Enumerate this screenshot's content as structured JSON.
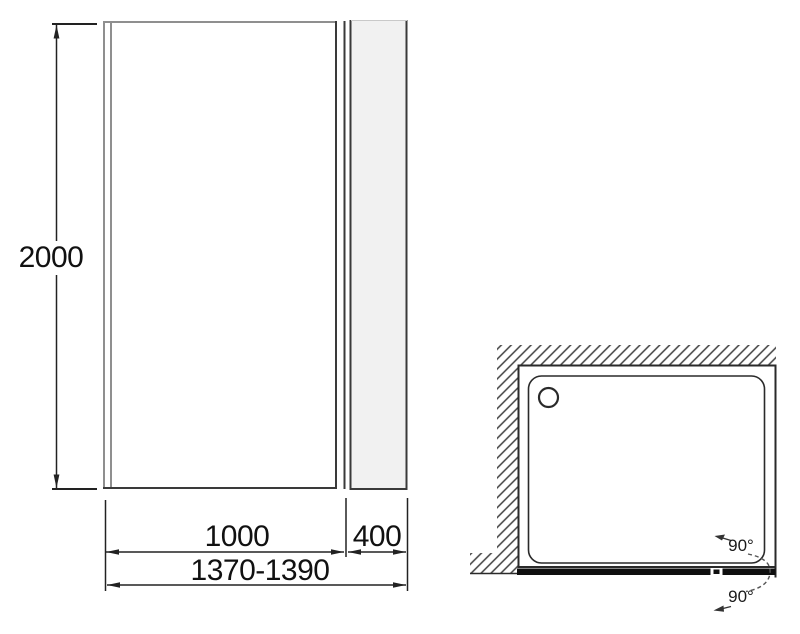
{
  "front_view": {
    "height_label": "2000",
    "door_width_label": "1000",
    "side_panel_width_label": "400",
    "total_width_label": "1370-1390"
  },
  "top_view": {
    "angle_upper_label": "90°",
    "angle_lower_label": "90°"
  },
  "icons": {
    "drain": "drain-circle",
    "wall_hatch": "wall-section-hatch"
  },
  "colors": {
    "background": "#ffffff",
    "line_dark": "#2a2a2a",
    "frame_gray": "#8f8f8f",
    "panel_fill": "#f1f1f1",
    "hatch": "#3f3f3f",
    "bar_black": "#0f0f0f",
    "leader_gray": "#555555"
  }
}
